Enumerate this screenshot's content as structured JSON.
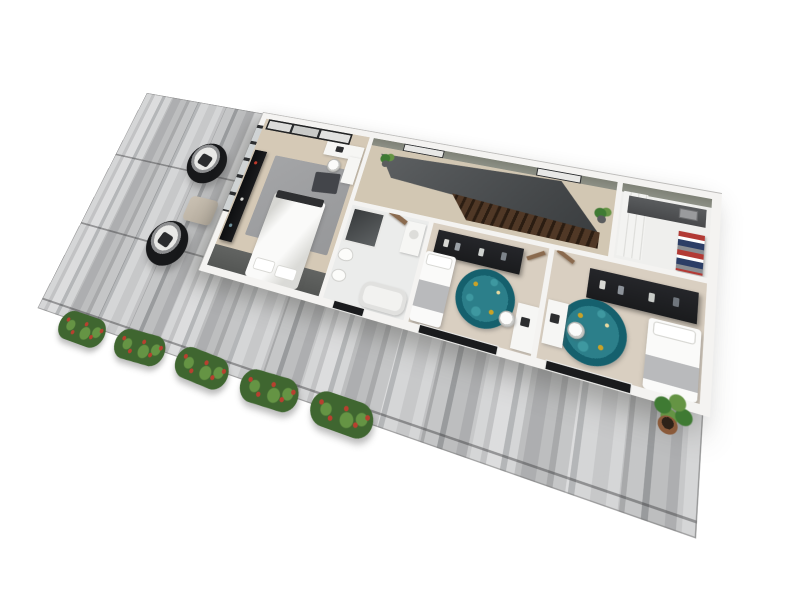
{
  "scene": {
    "type": "3d-floor-plan-render",
    "view": "top-down-perspective",
    "description": "Photorealistic 3D render of a single-storey apartment floor plan sitting on a gray plank deck, white background, no visible text"
  },
  "colors": {
    "page_bg": "#ffffff",
    "deck_light": "#cdcecf",
    "deck_lighter": "#d6d7d8",
    "deck_mid": "#b6b7b9",
    "deck_mid2": "#bcbdbf",
    "deck_dark": "#a6a8aa",
    "wall_white": "#f4f3f1",
    "wall_inner_sage": "#7e8176",
    "floor_wood": "#d5c9b6",
    "floor_hall": "#d2c7b3",
    "floor_tile": "#ebeceb",
    "floor_bedroom": "#d9cfc1",
    "floor_closet": "#efefed",
    "band_dark": "#545654",
    "rug_gray": "#97989a",
    "rug_teal": "#15606d",
    "rug_teal_light": "#3e98a0",
    "rug_gold": "#c9a227",
    "dark_furniture": "#1a1b1d",
    "stair_slate": "#393c3e",
    "stair_wood": "#503826",
    "bed_white": "#fafaf9",
    "blanket_gray": "#b9babc",
    "door_wood": "#8a6a4e",
    "window_frame": "#2b2d2f",
    "glass": "#e8e8e6",
    "shelf_gray": "#48494b",
    "clothes_red": "#b23a35",
    "clothes_navy": "#2c3e66",
    "chair_black": "#17181a",
    "ottoman": "#cac1b3",
    "shrub_green": "#3f6630",
    "shrub_light": "#659444",
    "shrub_red": "#b8402f",
    "plant_green": "#3f7a33",
    "pot_brown": "#8a5a3a"
  },
  "house": {
    "rooms": [
      {
        "id": "master-bedroom",
        "name": "master bedroom",
        "furniture": [
          "sliding-door closet",
          "double bed with white duvet",
          "gray area rug",
          "dark throw blanket",
          "corner desk with chair",
          "dark media unit",
          "window wall"
        ]
      },
      {
        "id": "hallway",
        "name": "hallway / landing",
        "furniture": [
          "stairwell void",
          "wooden stairs",
          "two potted plants",
          "two windows"
        ]
      },
      {
        "id": "bathroom",
        "name": "bathroom",
        "furniture": [
          "corner glass shower",
          "toilet",
          "bidet",
          "bathtub",
          "vanity with sink",
          "wood door"
        ]
      },
      {
        "id": "bedroom-2",
        "name": "bedroom 2",
        "furniture": [
          "open wardrobe with clothes",
          "single bed with gray blanket",
          "round teal rug",
          "desk with chair and laptop",
          "wood door",
          "bottom window"
        ]
      },
      {
        "id": "bedroom-3",
        "name": "bedroom 3",
        "furniture": [
          "open shelf with clothes",
          "single bed with gray blanket",
          "round teal rug",
          "desk with chair and laptop",
          "wood door",
          "bottom windows"
        ]
      },
      {
        "id": "walk-in-closet",
        "name": "walk-in closet",
        "furniture": [
          "wall shelf",
          "white cabinets",
          "stack of folded clothes"
        ]
      }
    ]
  },
  "outdoor": {
    "items": [
      {
        "id": "deck",
        "name": "gray plank deck"
      },
      {
        "id": "egg-chair-1",
        "name": "black wicker egg chair"
      },
      {
        "id": "egg-chair-2",
        "name": "black wicker egg chair"
      },
      {
        "id": "ottoman",
        "name": "beige ottoman table"
      },
      {
        "id": "shrub-row",
        "name": "five flowering shrubs along deck edge",
        "count": 5
      },
      {
        "id": "potted-plant",
        "name": "potted plant at bottom-right corner"
      }
    ]
  }
}
